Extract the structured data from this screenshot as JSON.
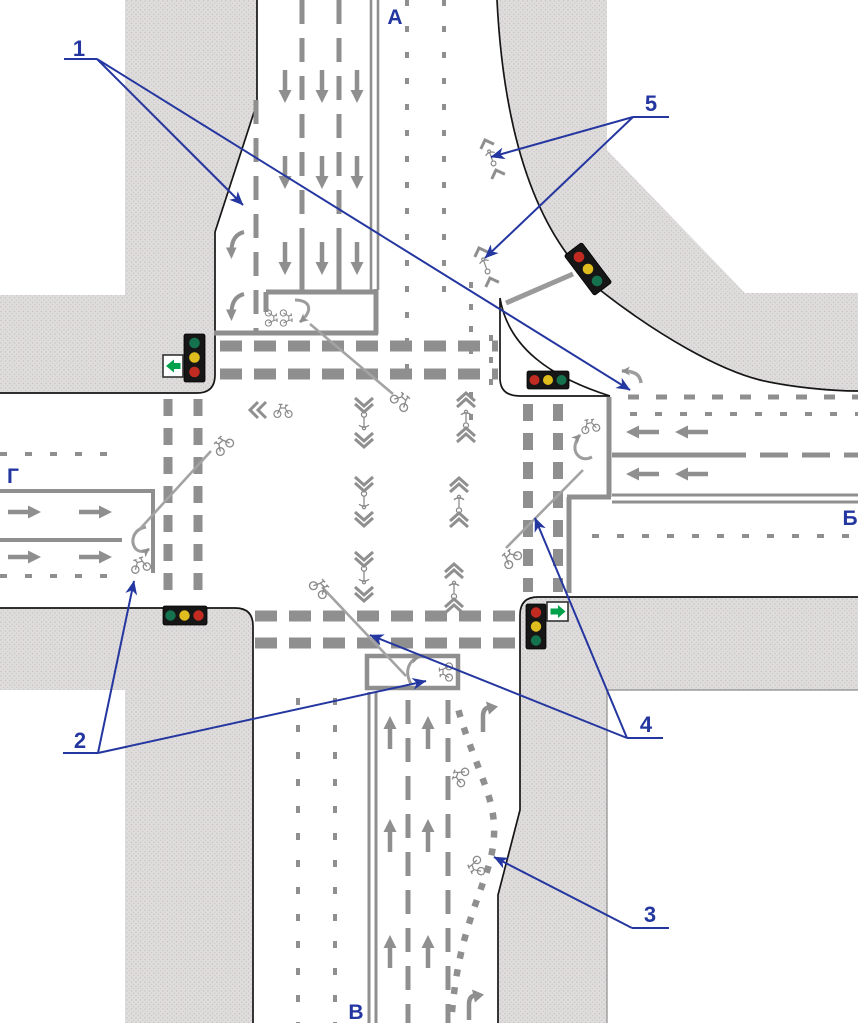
{
  "labels": {
    "north": "А",
    "east": "Б",
    "south": "В",
    "west": "Г"
  },
  "callouts": {
    "n1": "1",
    "n2": "2",
    "n3": "3",
    "n4": "4",
    "n5": "5"
  },
  "colors": {
    "callout_blue": "#2436a0",
    "sidewalk_gray": "#dedddd",
    "sidewalk_dot": "#c9c0be",
    "edge_black": "#161616",
    "marking_gray": "#8f8f8f",
    "trajectory_gray": "#a3a3a3",
    "light_housing": "#161616",
    "light_red": "#c22b21",
    "light_yellow": "#e0bd1e",
    "light_green": "#15724f",
    "sign_green": "#00a14b",
    "sign_white": "#ffffff"
  },
  "traffic_lights": [
    {
      "id": "northwest",
      "orientation": "vertical",
      "lamps": "green-yellow-red",
      "sign": "green-left-arrow"
    },
    {
      "id": "northeast",
      "orientation": "rotated",
      "lamps": "red-yellow-green",
      "sign": ""
    },
    {
      "id": "east-island",
      "orientation": "horizontal",
      "lamps": "red-yellow-green",
      "sign": ""
    },
    {
      "id": "southwest",
      "orientation": "horizontal",
      "lamps": "green-yellow-red",
      "sign": ""
    },
    {
      "id": "southeast",
      "orientation": "vertical",
      "lamps": "red-yellow-green",
      "sign": "green-right-arrow"
    }
  ]
}
